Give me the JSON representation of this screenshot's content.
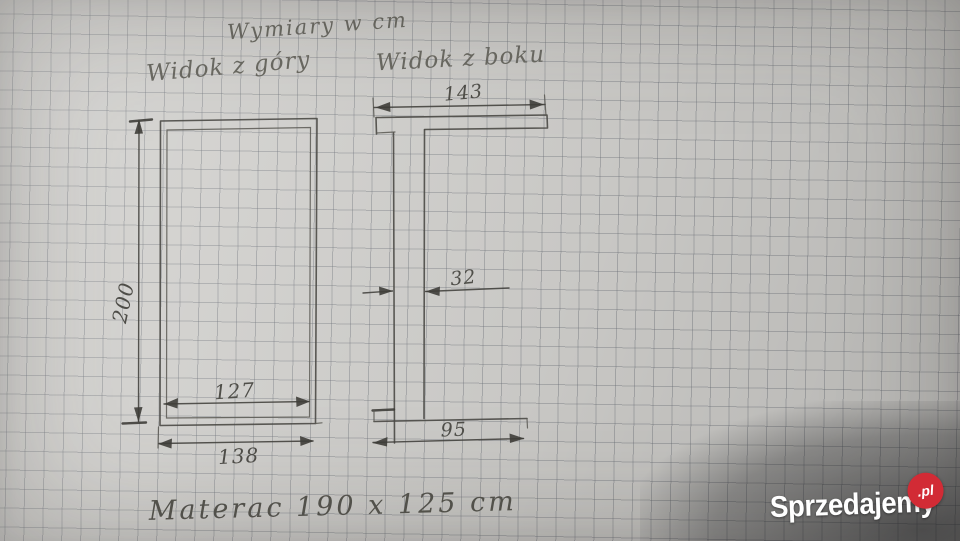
{
  "photo": {
    "note": "Wymiary w cm",
    "top_view_label": "Widok z góry",
    "side_view_label": "Widok z boku",
    "caption": "Materac  190 x 125 cm"
  },
  "dimensions": {
    "top_view": {
      "height": "200",
      "inner_width": "127",
      "outer_width": "138"
    },
    "side_view": {
      "top_length": "143",
      "thickness": "32",
      "base_length": "95"
    }
  },
  "watermark": {
    "brand": "Sprzedajemy",
    "tld": ".pl"
  },
  "colors": {
    "badge_red": "#d22b35",
    "pencil": "#4b4a46",
    "paper": "#cfcecb"
  }
}
